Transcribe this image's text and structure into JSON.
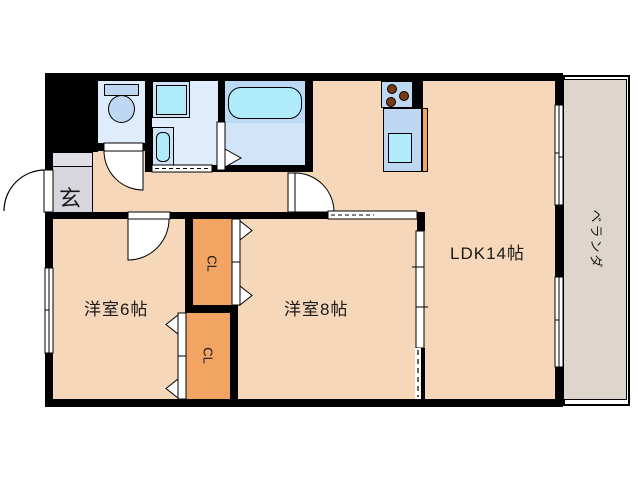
{
  "plan": {
    "title": "apartment-floor-plan",
    "entrance_label": "玄",
    "rooms": [
      {
        "id": "western-room-6",
        "label": "洋室6帖"
      },
      {
        "id": "western-room-8",
        "label": "洋室8帖"
      },
      {
        "id": "ldk",
        "label": "LDK14帖"
      }
    ],
    "closet_label": "CL",
    "balcony_label": "ベランダ",
    "fixtures": [
      "toilet",
      "washing-machine-pan",
      "vanity-sink",
      "bathtub",
      "stove",
      "kitchen-sink"
    ]
  },
  "colors": {
    "wall": "#000000",
    "floor": "#f6d7b9",
    "closet": "#f2a463",
    "counter": "#f2a463",
    "genkan": "#d6d6dc",
    "shoe-cab": "#dfdfe4",
    "wet-floor": "#dfecfb",
    "bath-upper": "#b9d9f4",
    "bath-lower": "#d2e5f8",
    "fixture-blue": "#bed8f4",
    "fixture-outer": "#cfe2f8",
    "water-cyan": "#b0ebfa",
    "burner-brown": "#7a3a10",
    "balcony": "#ded6cd",
    "line": "#000000"
  }
}
